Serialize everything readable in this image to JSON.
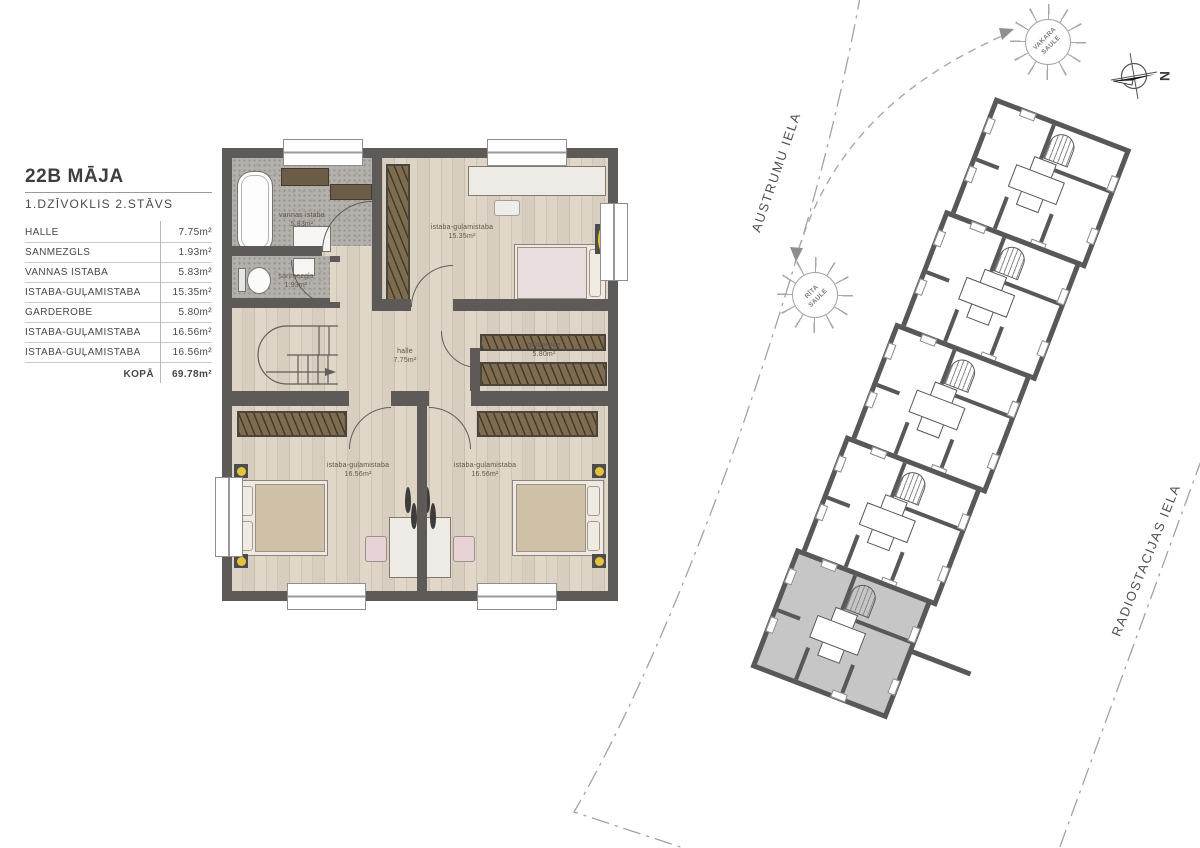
{
  "legend": {
    "title": "22B MĀJA",
    "subtitle": "1.DZĪVOKLIS 2.STĀVS",
    "rows": [
      {
        "label": "HALLE",
        "value": "7.75m²"
      },
      {
        "label": "SANMEZGLS",
        "value": "1.93m²"
      },
      {
        "label": "VANNAS ISTABA",
        "value": "5.83m²"
      },
      {
        "label": "ISTABA-GUĻAMISTABA",
        "value": "15.35m²"
      },
      {
        "label": "GARDEROBE",
        "value": "5.80m²"
      },
      {
        "label": "ISTABA-GUĻAMISTABA",
        "value": "16.56m²"
      },
      {
        "label": "ISTABA-GUĻAMISTABA",
        "value": "16.56m²"
      }
    ],
    "total_label": "KOPĀ",
    "total_value": "69.78m²"
  },
  "floorplan": {
    "rooms": [
      {
        "name": "vannas istaba",
        "area": "5.83m²"
      },
      {
        "name": "sanmezgls",
        "area": "1.93m²"
      },
      {
        "name": "istaba-guļamistaba",
        "area": "15.35m²"
      },
      {
        "name": "garderobe",
        "area": "5.80m²"
      },
      {
        "name": "halle",
        "area": "7.75m²"
      },
      {
        "name": "istaba-guļamistaba",
        "area": "16.56m²"
      },
      {
        "name": "istaba-guļamistaba",
        "area": "16.56m²"
      }
    ]
  },
  "siteplan": {
    "street_top": "AUSTRUMU IELA",
    "street_right": "RADIOSTACIJAS IELA",
    "sun_evening": "VAKARA SAULE",
    "sun_morning": "RĪTA SAULE",
    "compass": "N",
    "units_count": 5,
    "highlighted_unit_index": 4,
    "highlight_fill": "#c6c6c6"
  },
  "colors": {
    "wall": "#5d5a57",
    "wood": "#d9cfc0",
    "mosaic": "#b4b1ad",
    "closet": "#7d6c50",
    "accent_yellow": "#e6c23c"
  }
}
